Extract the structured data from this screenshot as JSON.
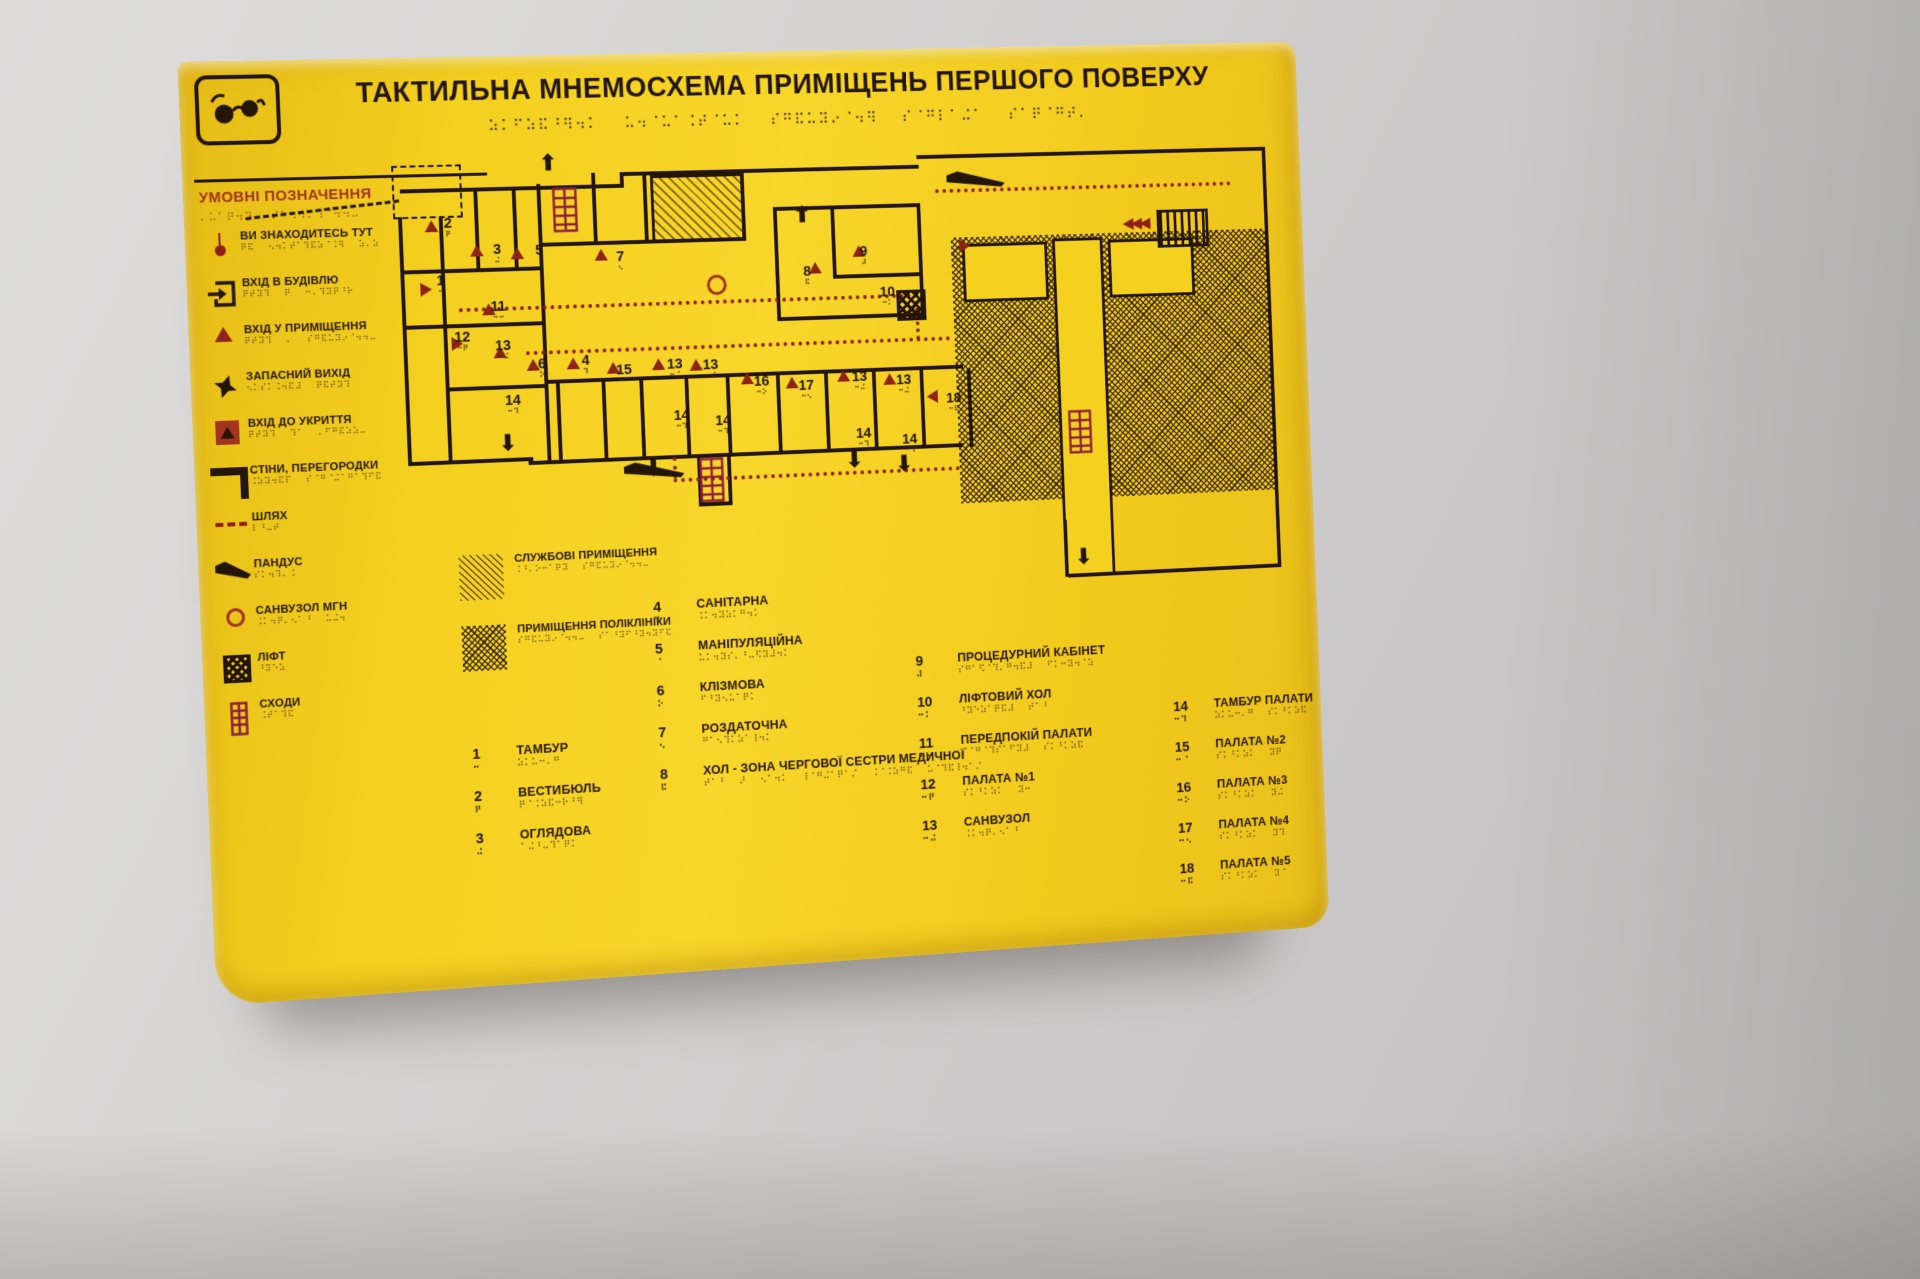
{
  "sign": {
    "title": "ТАКТИЛЬНА МНЕМОСХЕМА ПРИМІЩЕНЬ ПЕРШОГО ПОВЕРХУ",
    "logo_icon": "eyeglasses-icon",
    "legend_heading": "УМОВНІ ПОЗНАЧЕННЯ",
    "legend_items": [
      {
        "icon": "you-are-here-icon",
        "label": "ВИ ЗНАХОДИТЕСЬ ТУТ"
      },
      {
        "icon": "building-entrance-icon",
        "label": "ВХІД В БУДІВЛЮ"
      },
      {
        "icon": "room-entrance-icon",
        "label": "ВХІД У ПРИМІЩЕННЯ"
      },
      {
        "icon": "emergency-exit-icon",
        "label": "ЗАПАСНИЙ ВИХІД"
      },
      {
        "icon": "shelter-entrance-icon",
        "label": "ВХІД ДО УКРИТТЯ"
      },
      {
        "icon": "walls-partitions-icon",
        "label": "СТІНИ, ПЕРЕГОРОДКИ"
      },
      {
        "icon": "path-icon",
        "label": "ШЛЯХ"
      },
      {
        "icon": "ramp-icon",
        "label": "ПАНДУС"
      },
      {
        "icon": "accessible-wc-icon",
        "label": "САНВУЗОЛ МГН"
      },
      {
        "icon": "elevator-icon",
        "label": "ЛІФТ"
      },
      {
        "icon": "stairs-icon",
        "label": "СХОДИ"
      }
    ],
    "area_legend": [
      {
        "icon": "service-premises-hatch-icon",
        "label": "СЛУЖБОВІ ПРИМІЩЕННЯ"
      },
      {
        "icon": "polyclinic-premises-hatch-icon",
        "label": "ПРИМІЩЕННЯ ПОЛІКЛІНІКИ"
      }
    ],
    "room_directory": [
      {
        "items": [
          {
            "num": "1",
            "label": "ТАМБУР"
          },
          {
            "num": "2",
            "label": "ВЕСТИБЮЛЬ"
          },
          {
            "num": "3",
            "label": "ОГЛЯДОВА"
          }
        ]
      },
      {
        "items": [
          {
            "num": "4",
            "label": "САНІТАРНА"
          },
          {
            "num": "5",
            "label": "МАНІПУЛЯЦІЙНА"
          },
          {
            "num": "6",
            "label": "КЛІЗМОВА"
          },
          {
            "num": "7",
            "label": "РОЗДАТОЧНА"
          },
          {
            "num": "8",
            "label": "ХОЛ - ЗОНА ЧЕРГОВОЇ СЕСТРИ МЕДИЧНОЇ"
          }
        ]
      },
      {
        "items": [
          {
            "num": "9",
            "label": "ПРОЦЕДУРНИЙ КАБІНЕТ"
          },
          {
            "num": "10",
            "label": "ЛІФТОВИЙ ХОЛ"
          },
          {
            "num": "11",
            "label": "ПЕРЕДПОКІЙ ПАЛАТИ"
          },
          {
            "num": "12",
            "label": "ПАЛАТА №1"
          },
          {
            "num": "13",
            "label": "САНВУЗОЛ"
          }
        ]
      },
      {
        "items": [
          {
            "num": "14",
            "label": "ТАМБУР ПАЛАТИ"
          },
          {
            "num": "15",
            "label": "ПАЛАТА №2"
          },
          {
            "num": "16",
            "label": "ПАЛАТА №3"
          },
          {
            "num": "17",
            "label": "ПАЛАТА №4"
          },
          {
            "num": "18",
            "label": "ПАЛАТА №5"
          }
        ]
      }
    ],
    "plan": {
      "room_numbers": [
        {
          "n": "2",
          "x": 60,
          "y": 58
        },
        {
          "n": "3",
          "x": 110,
          "y": 86
        },
        {
          "n": "5",
          "x": 154,
          "y": 88
        },
        {
          "n": "7",
          "x": 239,
          "y": 97
        },
        {
          "n": "1",
          "x": 50,
          "y": 116
        },
        {
          "n": "11",
          "x": 105,
          "y": 144
        },
        {
          "n": "8",
          "x": 438,
          "y": 118
        },
        {
          "n": "9",
          "x": 500,
          "y": 99
        },
        {
          "n": "10",
          "x": 520,
          "y": 142
        },
        {
          "n": "12",
          "x": 66,
          "y": 174
        },
        {
          "n": "13",
          "x": 108,
          "y": 184
        },
        {
          "n": "6",
          "x": 152,
          "y": 204
        },
        {
          "n": "4",
          "x": 198,
          "y": 202
        },
        {
          "n": "15",
          "x": 234,
          "y": 213
        },
        {
          "n": "13",
          "x": 288,
          "y": 209
        },
        {
          "n": "13",
          "x": 326,
          "y": 211
        },
        {
          "n": "16",
          "x": 380,
          "y": 230
        },
        {
          "n": "17",
          "x": 428,
          "y": 236
        },
        {
          "n": "13",
          "x": 486,
          "y": 229
        },
        {
          "n": "13",
          "x": 534,
          "y": 234
        },
        {
          "n": "14",
          "x": 116,
          "y": 240
        },
        {
          "n": "18",
          "x": 588,
          "y": 255
        },
        {
          "n": "14",
          "x": 293,
          "y": 262
        },
        {
          "n": "14",
          "x": 337,
          "y": 269
        },
        {
          "n": "14",
          "x": 488,
          "y": 288
        },
        {
          "n": "14",
          "x": 538,
          "y": 296
        }
      ],
      "entrance_markers": [
        {
          "x": 40,
          "y": 62,
          "d": "u"
        },
        {
          "x": 86,
          "y": 88,
          "d": "u"
        },
        {
          "x": 128,
          "y": 92,
          "d": "u"
        },
        {
          "x": 216,
          "y": 96,
          "d": "u"
        },
        {
          "x": 32,
          "y": 126,
          "d": "r"
        },
        {
          "x": 96,
          "y": 148,
          "d": "u"
        },
        {
          "x": 62,
          "y": 182,
          "d": "r"
        },
        {
          "x": 106,
          "y": 192,
          "d": "u"
        },
        {
          "x": 140,
          "y": 206,
          "d": "u"
        },
        {
          "x": 182,
          "y": 206,
          "d": "u"
        },
        {
          "x": 224,
          "y": 212,
          "d": "u"
        },
        {
          "x": 272,
          "y": 210,
          "d": "u"
        },
        {
          "x": 312,
          "y": 212,
          "d": "u"
        },
        {
          "x": 366,
          "y": 228,
          "d": "u"
        },
        {
          "x": 414,
          "y": 234,
          "d": "u"
        },
        {
          "x": 470,
          "y": 229,
          "d": "u"
        },
        {
          "x": 520,
          "y": 234,
          "d": "u"
        },
        {
          "x": 444,
          "y": 116,
          "d": "u"
        },
        {
          "x": 492,
          "y": 100,
          "d": "u"
        },
        {
          "x": 566,
          "y": 254,
          "d": "l"
        },
        {
          "x": 608,
          "y": 98,
          "d": "r"
        }
      ],
      "exit_arrows": [
        {
          "g": "up",
          "x": 162,
          "y": -4
        },
        {
          "g": "up",
          "x": 430,
          "y": 56
        },
        {
          "g": "down",
          "x": 108,
          "y": 280
        },
        {
          "g": "down",
          "x": 260,
          "y": 312
        },
        {
          "g": "down",
          "x": 476,
          "y": 312
        },
        {
          "g": "down",
          "x": 530,
          "y": 318
        },
        {
          "g": "down",
          "x": 724,
          "y": 424
        },
        {
          "g": "left-left",
          "x": 792,
          "y": 78
        }
      ]
    },
    "colors": {
      "panel_yellow": "#f2cc1d",
      "ink": "#241607",
      "legend_red": "#a23420",
      "path_red": "#8e1f12",
      "stairs_red": "#8e1f3a"
    }
  }
}
